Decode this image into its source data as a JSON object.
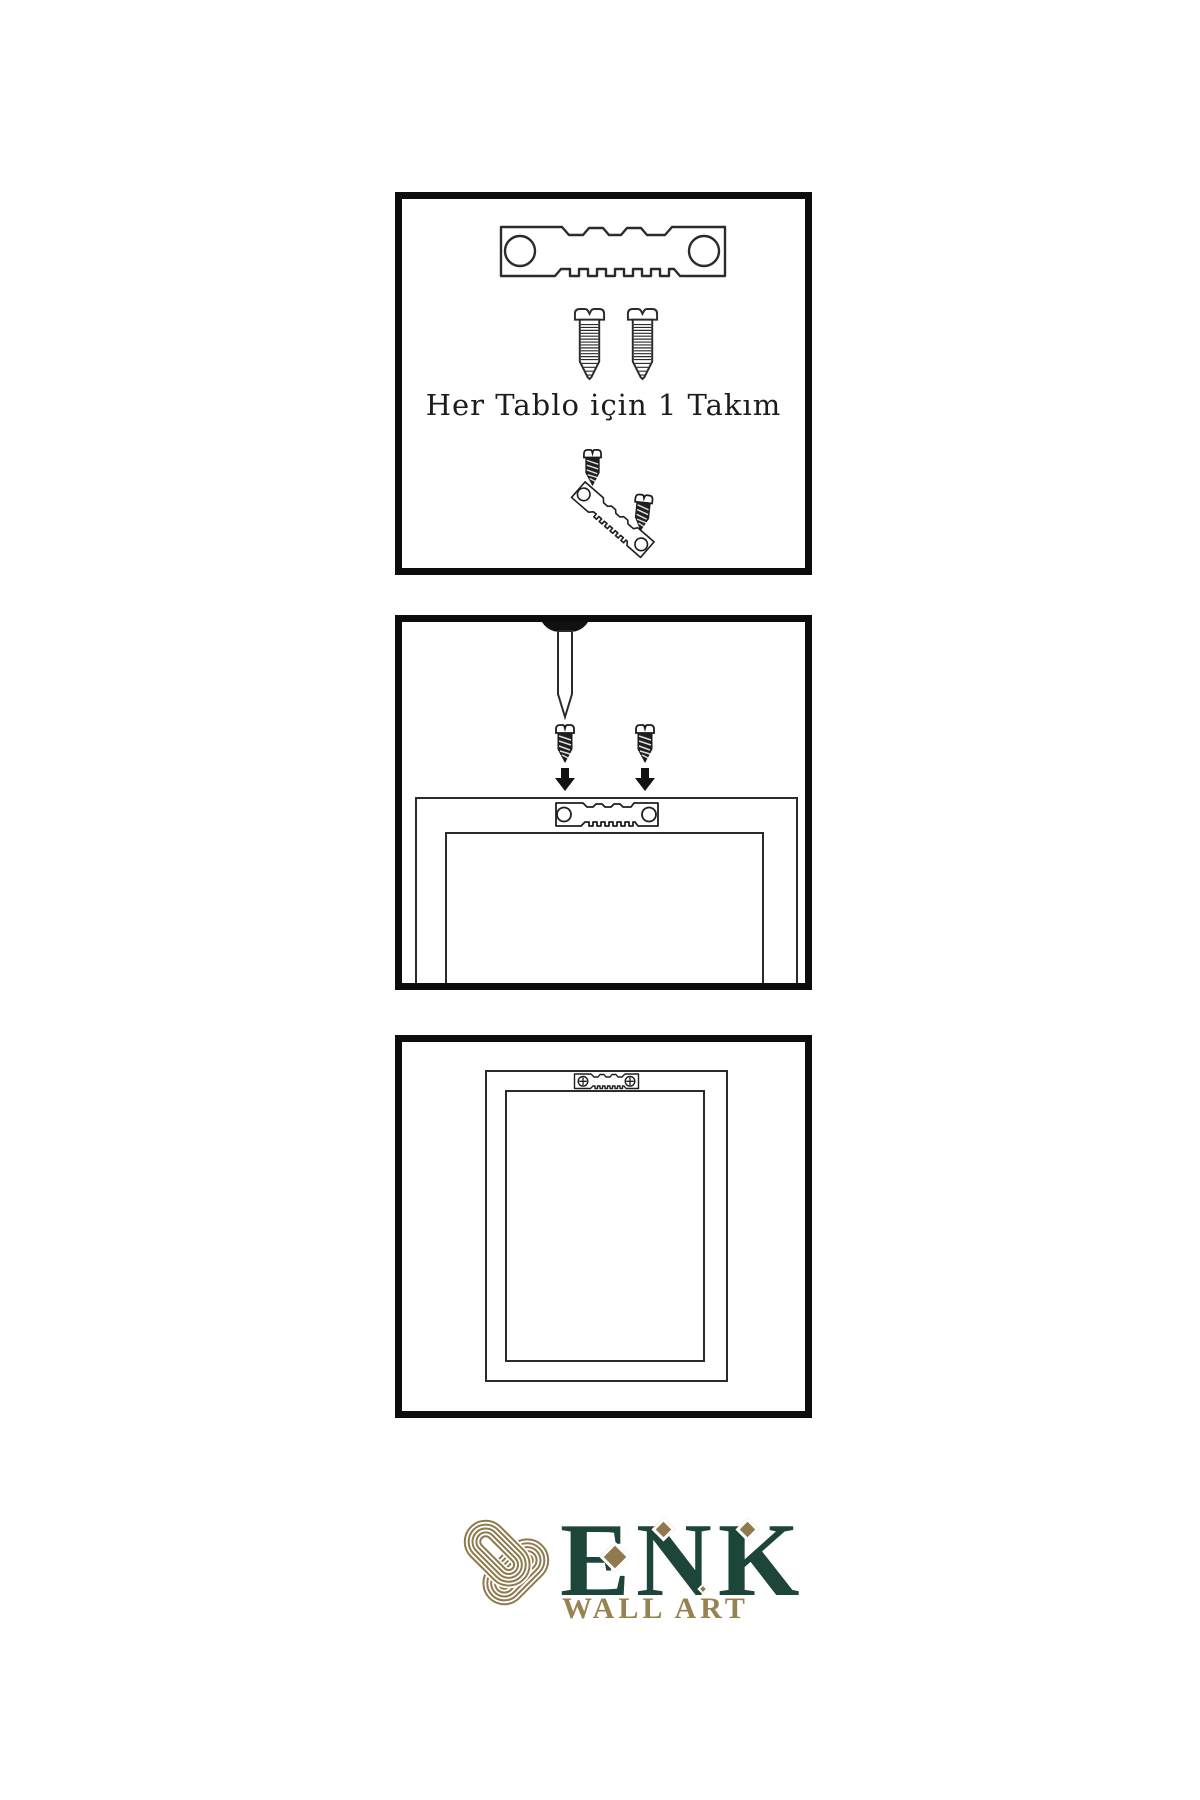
{
  "theme": {
    "ink": "#0d0d0d",
    "line": "#2b2b2b",
    "green": "#1d4539",
    "gold": "#8e7a4e",
    "gold_text": "#97834f",
    "background": "#ffffff"
  },
  "steps": {
    "step1": {
      "caption": "Her Tablo için 1 Takım",
      "icons": [
        "sawtooth-hanger-icon",
        "screw-icon",
        "screw-icon",
        "dark-screw-icon",
        "tilted-sawtooth-hanger-icon",
        "dark-screw-icon"
      ]
    },
    "step2": {
      "icons": [
        "nail-icon",
        "dark-screw-icon",
        "dark-screw-icon",
        "down-arrow-icon",
        "down-arrow-icon",
        "sawtooth-hanger-icon",
        "frame-back-view"
      ]
    },
    "step3": {
      "icons": [
        "framed-picture-front-view",
        "sawtooth-hanger-with-screws-icon"
      ]
    }
  },
  "brand": {
    "name": "ENK",
    "tagline": "WALL ART",
    "icons": [
      "knot-icon"
    ]
  }
}
